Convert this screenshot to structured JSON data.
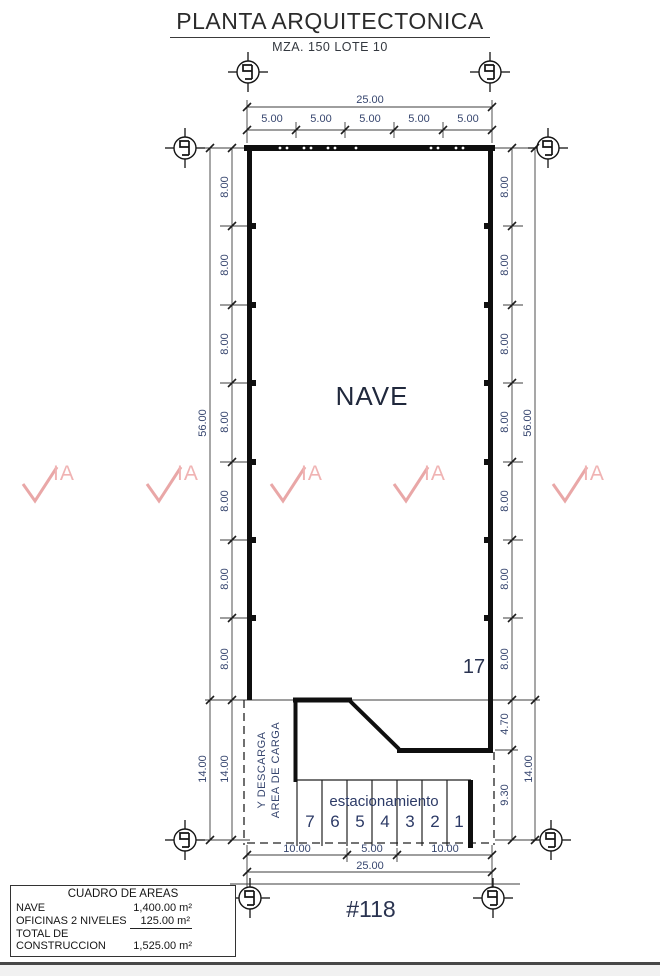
{
  "header": {
    "title": "PLANTA ARQUITECTONICA",
    "subtitle": "MZA. 150   LOTE 10"
  },
  "plan": {
    "nave_label": "NAVE",
    "lot_number": "17",
    "address": "#118",
    "parking_label": "estacionamiento",
    "parking_spaces": [
      "7",
      "6",
      "5",
      "4",
      "3",
      "2",
      "1"
    ],
    "loading_area_line1": "Y DESCARGA",
    "loading_area_line2": "AREA DE CARGA"
  },
  "dims": {
    "top_total": "25.00",
    "top_segments": [
      "5.00",
      "5.00",
      "5.00",
      "5.00",
      "5.00"
    ],
    "left_total": "56.00",
    "left_segments": [
      "8.00",
      "8.00",
      "8.00",
      "8.00",
      "8.00",
      "8.00",
      "8.00"
    ],
    "right_total": "56.00",
    "right_segments": [
      "8.00",
      "8.00",
      "8.00",
      "8.00",
      "8.00",
      "8.00",
      "8.00"
    ],
    "lower_total": "14.00",
    "seg_470": "4.70",
    "seg_930": "9.30",
    "bottom_segments": [
      "10.00",
      "5.00",
      "10.00"
    ],
    "bottom_total": "25.00"
  },
  "areas_table": {
    "title": "CUADRO DE AREAS",
    "rows": [
      {
        "label": "NAVE",
        "value": "1,400.00 m²"
      },
      {
        "label": "OFICINAS 2 NIVELES",
        "value": "125.00 m²"
      },
      {
        "label_line1": "TOTAL DE",
        "label_line2": "CONSTRUCCION",
        "value": "1,525.00 m²"
      }
    ]
  },
  "watermark": {
    "text": "IA"
  },
  "colors": {
    "wall": "#0f0f0f",
    "dim_text": "#37466f",
    "watermark_pink": "#e9a7a7"
  }
}
